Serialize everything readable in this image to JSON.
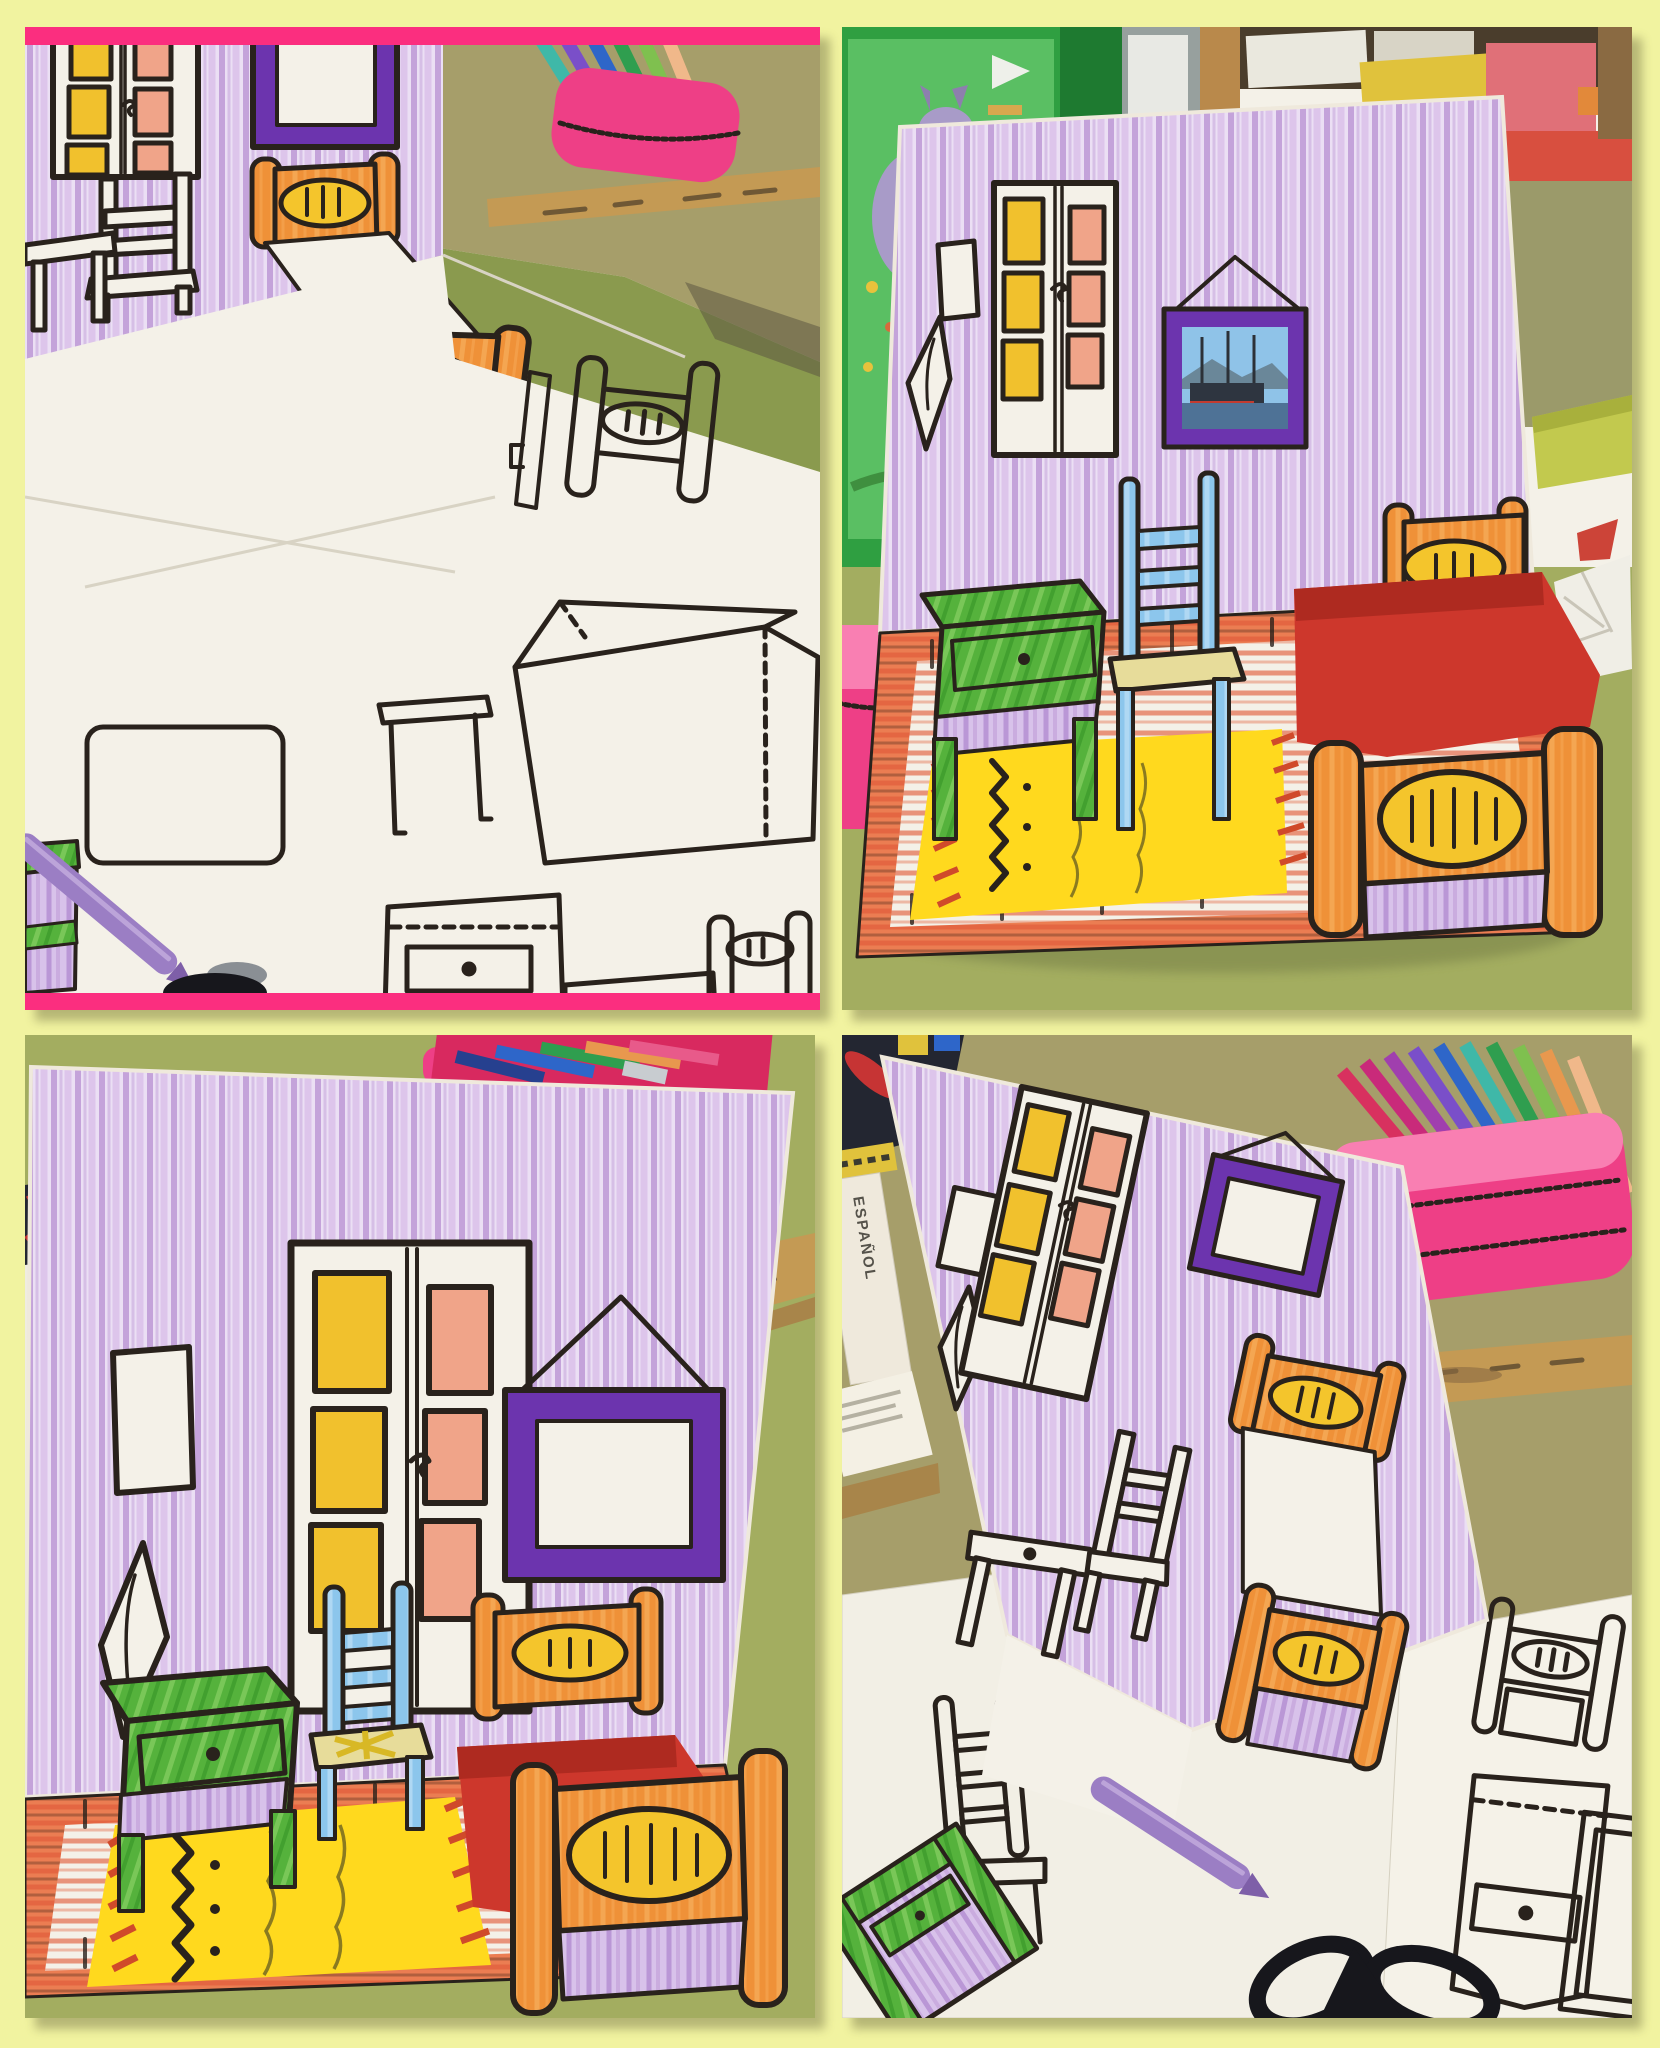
{
  "meta": {
    "type": "photo-collage",
    "subject": "Four classroom photos of a children's pop-up paper craft recreating Van Gogh's Bedroom in Arles",
    "grid": "2x2"
  },
  "collage": {
    "background": "#f1f3a0",
    "photos": [
      {
        "id": "top-left",
        "position": "top-left",
        "accent_strips": true,
        "description": "Work-in-progress pop-up bedroom card lying over uncoloured cut-out furniture templates; hot-pink strips frame the photo top and bottom"
      },
      {
        "id": "top-right",
        "position": "top-right",
        "accent_strips": false,
        "description": "Finished pop-up bedroom card standing on a green classroom desk in front of shelves and a wall poster; the picture frame holds a glued photo of ships"
      },
      {
        "id": "bottom-left",
        "position": "bottom-left",
        "accent_strips": false,
        "description": "Close-up of the finished pop-up bedroom: purple wall, wardrobe, blue chair, green washstand, orange bed with red blanket and yellow rug"
      },
      {
        "id": "bottom-right",
        "position": "bottom-right",
        "accent_strips": false,
        "description": "Tilted pop-up card with the orange bed popped out, surrounded by templates, pencil cases, rulers, a purple crayon and scissors"
      }
    ]
  },
  "photos": {
    "bottom_right": {
      "book_spine_text": "ESPAÑOL"
    }
  },
  "scene_elements": {
    "top_left": [
      "purple crayoned wall",
      "wardrobe with yellow and salmon panels",
      "uncoloured chair drawing",
      "uncoloured table drawing",
      "purple picture frame",
      "orange pop-up bed with white sheet",
      "uncoloured furniture templates",
      "purple crayon",
      "green-and-purple washstand cut-out",
      "scissors tip",
      "pink pencil case with colouring pencils",
      "wooden ruler",
      "classroom desk"
    ],
    "top_right": [
      "classroom green wall with poster",
      "wooden shelf with red edge and folders",
      "purple crayoned wall",
      "small window",
      "pillow sketch",
      "wardrobe",
      "purple frame with glued ship photo",
      "blue chair",
      "green washstand",
      "orange bed with red paper blanket",
      "yellow paper rug",
      "red crayon floorboards",
      "green desk",
      "pink pencil case",
      "crumpled paper"
    ],
    "bottom_left": [
      "purple crayoned wall",
      "small window",
      "pillow sketch",
      "wardrobe with yellow and salmon panels",
      "empty purple picture frame",
      "blue chair with yellow seat",
      "green washstand",
      "orange bed with red paper blanket",
      "yellow paper rug with zigzag",
      "red crayon floorboards",
      "green desk",
      "pencil case with pencils",
      "wooden ruler"
    ],
    "bottom_right": [
      "tilted purple wall card",
      "wardrobe",
      "small window",
      "pillow sketch",
      "empty purple picture frame",
      "uncoloured chair and table drawings",
      "orange bed popped up with white sheet",
      "uncoloured furniture templates",
      "green-and-purple washstand cut-out",
      "purple crayon",
      "black scissors",
      "pink pencil case with fanned pencils",
      "wooden rulers",
      "book spine",
      "red and black pencil case"
    ]
  },
  "palette": {
    "frame_yellow": "#f1f3a0",
    "frame_pink": "#fb2e7f",
    "ink": "#29221c",
    "paper_white": "#f4f1e8",
    "paper_shade": "#e0dbcc",
    "wall_paper": "#ebdff4",
    "wall_purple": "#b78fd2",
    "wall_purple2": "#d3b4e5",
    "panel_purple": "#d8c2ea",
    "panel_purple2": "#ae84cd",
    "door_yellow": "#f1c12d",
    "door_salmon": "#f0a489",
    "frame_violet": "#6c34ae",
    "bed_orange": "#ef9138",
    "bed_orange_light": "#f8b768",
    "oval_yellow": "#f4c52c",
    "blanket_red": "#cd372c",
    "blanket_red_dark": "#ae2a20",
    "rug_yellow": "#ffd91e",
    "floor_red": "#e2603e",
    "floor_red_dark": "#8a4a2f",
    "floor_border": "#eb7d52",
    "chair_blue": "#8cc6ec",
    "chair_blue_light": "#c6e4f8",
    "seat_yellow": "#e7dc9a",
    "seat_scribble": "#d8b825",
    "green_main": "#55b23c",
    "green_light": "#90d56a",
    "green_dark": "#2f8d22",
    "desk_olive": "#a3ad60",
    "desk_olive_dark": "#8a9a4e",
    "desk_khaki": "#a69e6a",
    "shadow_dark": "#5c5742",
    "class_green": "#2f9f41",
    "poster_green": "#5abf63",
    "class_green_dark": "#1e7a30",
    "door_grey": "#97a09e",
    "panel_white": "#e8e9e4",
    "wood": "#b9894b",
    "wood_dark": "#8a6a42",
    "shelf_red": "#d84f3f",
    "shelf_chartreuse": "#c2c94e",
    "case_pink": "#ee3f86",
    "case_pink_light": "#f97fb2",
    "case_magenta": "#d8295f",
    "zipper_grey": "#d8dadd",
    "ruler_wood": "#c49a54",
    "ruler_wood_dark": "#a8854a",
    "crayon_purple": "#9b7ec4",
    "crayon_purple_dark": "#7e5fa8",
    "scissors_black": "#17171c",
    "photo_sky": "#8fc3e8",
    "photo_mtn": "#6a8799",
    "photo_ship": "#2e3540",
    "photo_red": "#c33b2f",
    "photo_water": "#4e7296",
    "poster_purple": "#a89bc8",
    "book_paper": "#efe9dc",
    "book_text": "#55524a",
    "tin_yellow": "#e0c23c",
    "case_black": "#232631",
    "case_red": "#c63434",
    "pen_teal": "#3fb8a8",
    "pen_purple": "#7a4fc9",
    "pen_violet": "#a03fae",
    "pen_blue": "#2e66c9",
    "pen_navy": "#26408f",
    "pen_green": "#2f9e4f",
    "pen_lime": "#7fc04f",
    "pen_orange": "#e8984e",
    "pen_peach": "#f0b88a",
    "pen_magenta": "#c92a7a",
    "pen_pink": "#e85a8a",
    "pen_red": "#d8315f",
    "pen_grey": "#c8ccd0"
  }
}
